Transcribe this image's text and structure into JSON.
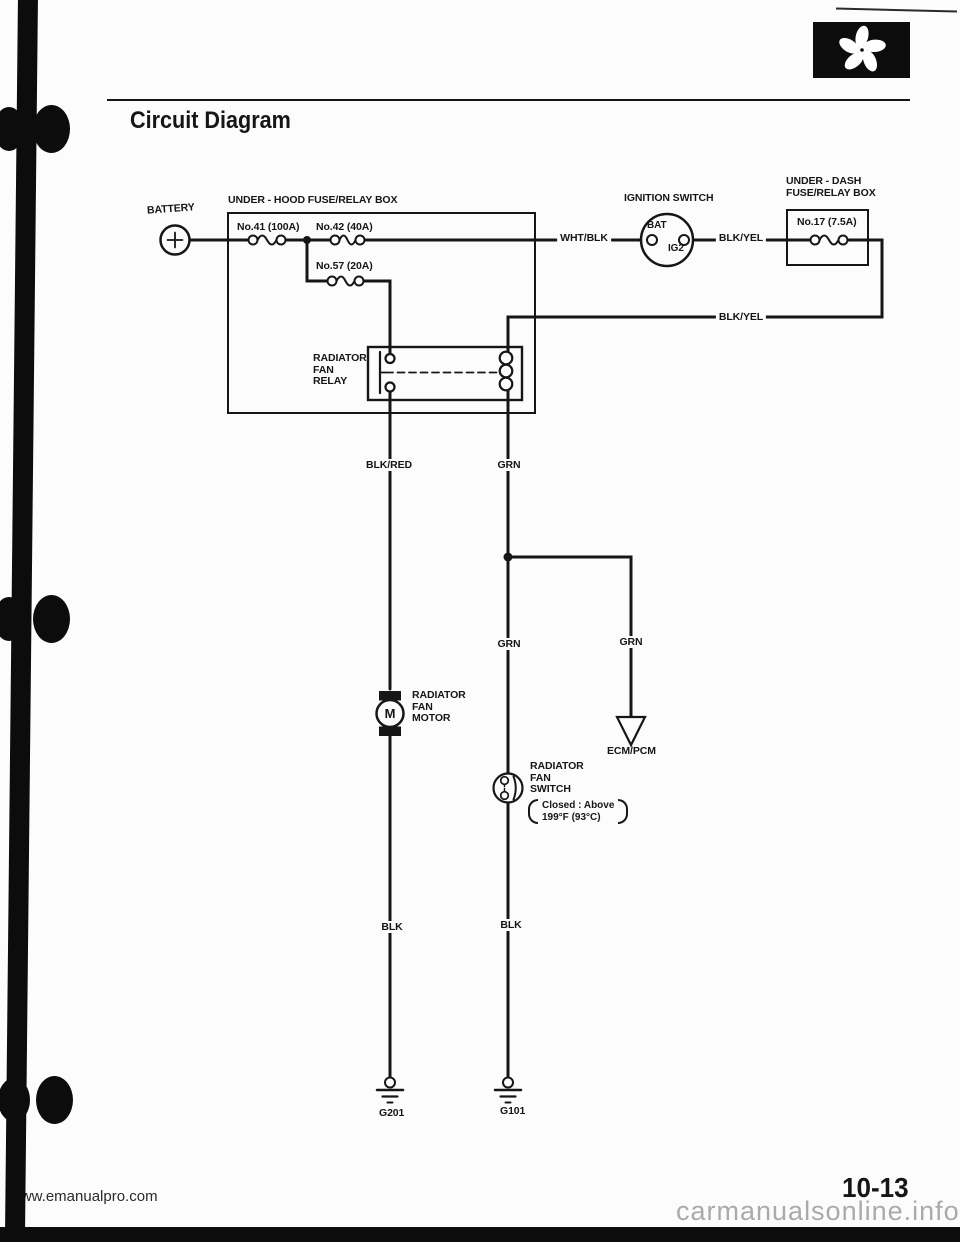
{
  "colors": {
    "ink": "#161616",
    "paper": "#fcfcfc",
    "watermark_gray": "#aaaaaa"
  },
  "header": {
    "title": "Circuit Diagram"
  },
  "icons": {
    "corner_stamp": "fan-icon",
    "binder": "binder-ring-icon"
  },
  "diagram": {
    "battery": {
      "label": "BATTERY"
    },
    "underhood_box": {
      "label": "UNDER - HOOD FUSE/RELAY BOX",
      "fuse41": "No.41 (100A)",
      "fuse42": "No.42 (40A)",
      "fuse57": "No.57 (20A)"
    },
    "relay": {
      "lines": [
        "RADIATOR",
        "FAN",
        "RELAY"
      ]
    },
    "ignition": {
      "label": "IGNITION SWITCH",
      "bat": "BAT",
      "ig2": "IG2"
    },
    "underdash_box": {
      "lines": [
        "UNDER - DASH",
        "FUSE/RELAY BOX"
      ],
      "fuse17": "No.17 (7.5A)"
    },
    "wires": {
      "wht_blk": "WHT/BLK",
      "blk_yel": "BLK/YEL",
      "blk_red": "BLK/RED",
      "grn": "GRN",
      "blk": "BLK"
    },
    "motor": {
      "symbol": "M",
      "lines": [
        "RADIATOR",
        "FAN",
        "MOTOR"
      ]
    },
    "ecm": {
      "label": "ECM/PCM"
    },
    "fan_switch": {
      "lines": [
        "RADIATOR",
        "FAN",
        "SWITCH"
      ],
      "note_lines": [
        "Closed : Above",
        "199°F (93°C)"
      ]
    },
    "grounds": {
      "g201": "G201",
      "g101": "G101"
    }
  },
  "footer": {
    "page_number": "10-13",
    "watermark_left": "www.emanualpro.com",
    "watermark_right": "carmanualsonline.info"
  }
}
